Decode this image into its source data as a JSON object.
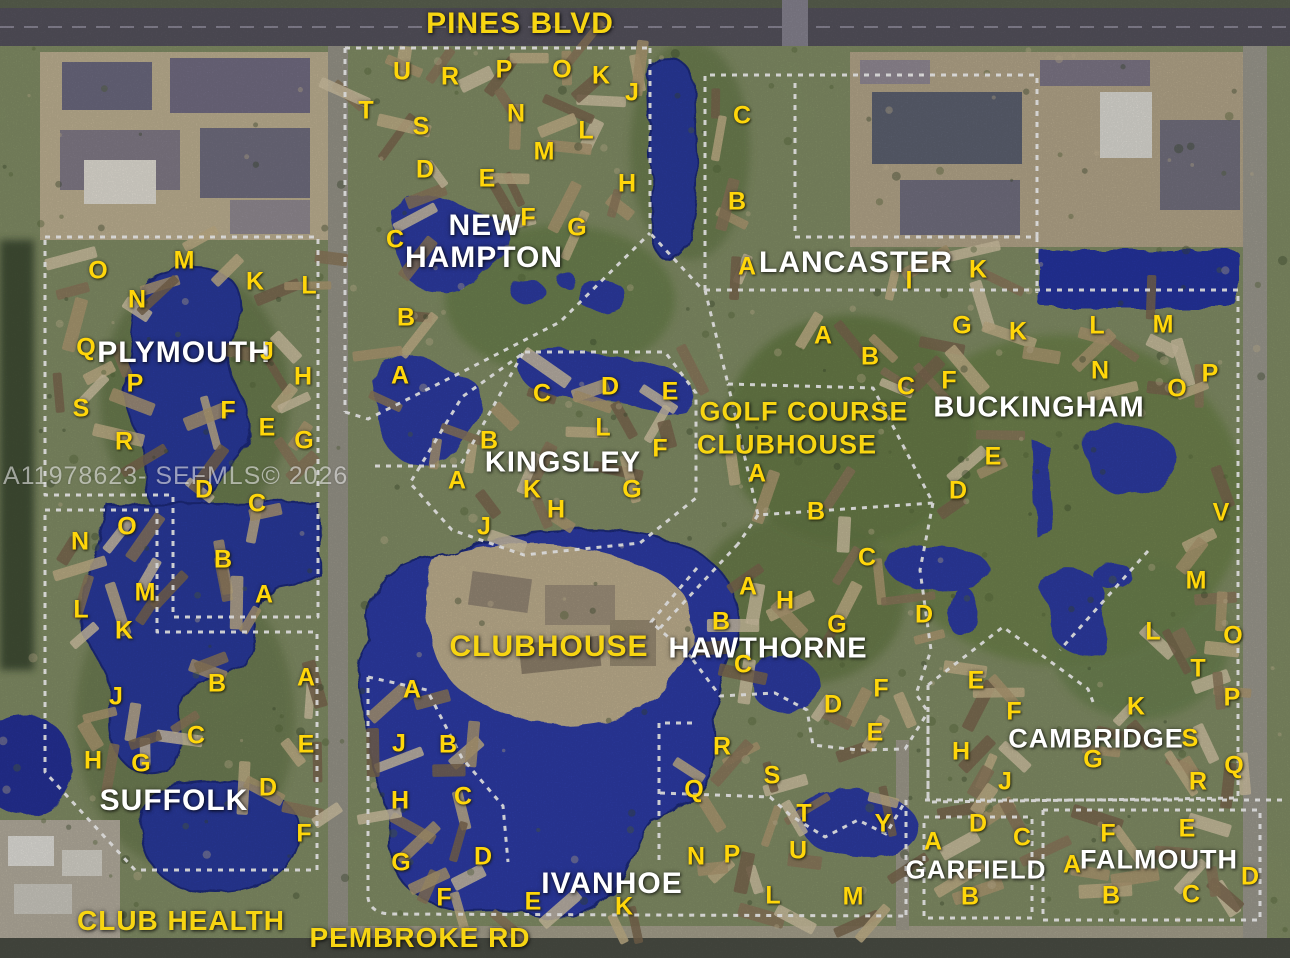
{
  "map": {
    "watermark": "A11978623- SEFMLS© 2026",
    "roads": {
      "labels": [
        {
          "text": "PINES BLVD",
          "x": 520,
          "y": 24,
          "size": 30
        },
        {
          "text": "PEMBROKE RD",
          "x": 420,
          "y": 938,
          "size": 28
        },
        {
          "text": "CLUB HEALTH",
          "x": 181,
          "y": 921,
          "size": 28
        }
      ]
    },
    "facilities": [
      {
        "text": "CLUBHOUSE",
        "x": 549,
        "y": 647,
        "size": 30,
        "color": "yellow"
      },
      {
        "text": "GOLF COURSE",
        "x": 804,
        "y": 412,
        "size": 27,
        "color": "yellow"
      },
      {
        "text": "CLUBHOUSE",
        "x": 787,
        "y": 445,
        "size": 27,
        "color": "yellow"
      }
    ],
    "neighborhoods": [
      {
        "name": "NEW HAMPTON",
        "labels": [
          {
            "text": "NEW",
            "x": 485,
            "y": 226,
            "size": 30
          },
          {
            "text": "HAMPTON",
            "x": 484,
            "y": 258,
            "size": 30
          }
        ],
        "letters": [
          {
            "t": "U",
            "x": 402,
            "y": 72
          },
          {
            "t": "R",
            "x": 450,
            "y": 77
          },
          {
            "t": "P",
            "x": 504,
            "y": 70
          },
          {
            "t": "O",
            "x": 562,
            "y": 70
          },
          {
            "t": "K",
            "x": 601,
            "y": 76
          },
          {
            "t": "J",
            "x": 632,
            "y": 93
          },
          {
            "t": "T",
            "x": 366,
            "y": 111
          },
          {
            "t": "S",
            "x": 421,
            "y": 127
          },
          {
            "t": "N",
            "x": 516,
            "y": 114
          },
          {
            "t": "L",
            "x": 586,
            "y": 131
          },
          {
            "t": "M",
            "x": 544,
            "y": 152
          },
          {
            "t": "D",
            "x": 425,
            "y": 170
          },
          {
            "t": "E",
            "x": 487,
            "y": 179
          },
          {
            "t": "H",
            "x": 627,
            "y": 184
          },
          {
            "t": "F",
            "x": 528,
            "y": 218
          },
          {
            "t": "G",
            "x": 577,
            "y": 228
          },
          {
            "t": "C",
            "x": 395,
            "y": 240
          },
          {
            "t": "B",
            "x": 406,
            "y": 318
          },
          {
            "t": "A",
            "x": 400,
            "y": 376
          }
        ]
      },
      {
        "name": "KINGSLEY",
        "labels": [
          {
            "text": "KINGSLEY",
            "x": 563,
            "y": 463,
            "size": 29
          }
        ],
        "letters": [
          {
            "t": "C",
            "x": 542,
            "y": 394
          },
          {
            "t": "D",
            "x": 610,
            "y": 387
          },
          {
            "t": "E",
            "x": 670,
            "y": 392
          },
          {
            "t": "L",
            "x": 603,
            "y": 428
          },
          {
            "t": "B",
            "x": 489,
            "y": 441
          },
          {
            "t": "F",
            "x": 660,
            "y": 449
          },
          {
            "t": "A",
            "x": 457,
            "y": 481
          },
          {
            "t": "K",
            "x": 532,
            "y": 490
          },
          {
            "t": "G",
            "x": 632,
            "y": 490
          },
          {
            "t": "H",
            "x": 556,
            "y": 510
          },
          {
            "t": "J",
            "x": 484,
            "y": 527
          }
        ]
      },
      {
        "name": "PLYMOUTH",
        "labels": [
          {
            "text": "PLYMOUTH",
            "x": 184,
            "y": 353,
            "size": 30
          }
        ],
        "letters": [
          {
            "t": "M",
            "x": 184,
            "y": 261
          },
          {
            "t": "O",
            "x": 98,
            "y": 271
          },
          {
            "t": "K",
            "x": 255,
            "y": 282
          },
          {
            "t": "L",
            "x": 309,
            "y": 286
          },
          {
            "t": "N",
            "x": 137,
            "y": 300
          },
          {
            "t": "Q",
            "x": 86,
            "y": 348
          },
          {
            "t": "J",
            "x": 267,
            "y": 352
          },
          {
            "t": "H",
            "x": 303,
            "y": 377
          },
          {
            "t": "P",
            "x": 135,
            "y": 384
          },
          {
            "t": "S",
            "x": 81,
            "y": 409
          },
          {
            "t": "F",
            "x": 228,
            "y": 411
          },
          {
            "t": "E",
            "x": 267,
            "y": 428
          },
          {
            "t": "R",
            "x": 124,
            "y": 442
          },
          {
            "t": "G",
            "x": 304,
            "y": 441
          },
          {
            "t": "D",
            "x": 204,
            "y": 490
          },
          {
            "t": "C",
            "x": 257,
            "y": 504
          }
        ]
      },
      {
        "name": "SUFFOLK",
        "labels": [
          {
            "text": "SUFFOLK",
            "x": 174,
            "y": 801,
            "size": 30
          }
        ],
        "letters": [
          {
            "t": "O",
            "x": 127,
            "y": 527
          },
          {
            "t": "N",
            "x": 80,
            "y": 542
          },
          {
            "t": "B",
            "x": 223,
            "y": 560
          },
          {
            "t": "M",
            "x": 145,
            "y": 593
          },
          {
            "t": "A",
            "x": 264,
            "y": 595
          },
          {
            "t": "L",
            "x": 81,
            "y": 610
          },
          {
            "t": "K",
            "x": 124,
            "y": 631
          },
          {
            "t": "B",
            "x": 217,
            "y": 684
          },
          {
            "t": "A",
            "x": 306,
            "y": 678
          },
          {
            "t": "J",
            "x": 116,
            "y": 697
          },
          {
            "t": "C",
            "x": 196,
            "y": 736
          },
          {
            "t": "E",
            "x": 306,
            "y": 745
          },
          {
            "t": "H",
            "x": 93,
            "y": 761
          },
          {
            "t": "G",
            "x": 141,
            "y": 764
          },
          {
            "t": "D",
            "x": 268,
            "y": 788
          },
          {
            "t": "F",
            "x": 304,
            "y": 834
          }
        ]
      },
      {
        "name": "LANCASTER",
        "labels": [
          {
            "text": "LANCASTER",
            "x": 856,
            "y": 263,
            "size": 30
          }
        ],
        "letters": [
          {
            "t": "C",
            "x": 742,
            "y": 116
          },
          {
            "t": "B",
            "x": 737,
            "y": 202
          },
          {
            "t": "A",
            "x": 747,
            "y": 267
          },
          {
            "t": "I",
            "x": 909,
            "y": 281
          },
          {
            "t": "K",
            "x": 978,
            "y": 270
          }
        ]
      },
      {
        "name": "BUCKINGHAM",
        "labels": [
          {
            "text": "BUCKINGHAM",
            "x": 1039,
            "y": 408,
            "size": 29
          }
        ],
        "letters": [
          {
            "t": "A",
            "x": 823,
            "y": 336
          },
          {
            "t": "B",
            "x": 870,
            "y": 357
          },
          {
            "t": "G",
            "x": 962,
            "y": 326
          },
          {
            "t": "K",
            "x": 1018,
            "y": 332
          },
          {
            "t": "C",
            "x": 906,
            "y": 387
          },
          {
            "t": "F",
            "x": 949,
            "y": 381
          },
          {
            "t": "L",
            "x": 1097,
            "y": 326
          },
          {
            "t": "M",
            "x": 1163,
            "y": 325
          },
          {
            "t": "N",
            "x": 1100,
            "y": 371
          },
          {
            "t": "P",
            "x": 1210,
            "y": 374
          },
          {
            "t": "O",
            "x": 1177,
            "y": 389
          },
          {
            "t": "E",
            "x": 993,
            "y": 457
          },
          {
            "t": "D",
            "x": 958,
            "y": 491
          },
          {
            "t": "A",
            "x": 757,
            "y": 474
          },
          {
            "t": "B",
            "x": 816,
            "y": 512
          },
          {
            "t": "V",
            "x": 1221,
            "y": 513
          }
        ]
      },
      {
        "name": "HAWTHORNE",
        "labels": [
          {
            "text": "HAWTHORNE",
            "x": 768,
            "y": 649,
            "size": 29
          }
        ],
        "letters": [
          {
            "t": "C",
            "x": 867,
            "y": 558
          },
          {
            "t": "A",
            "x": 748,
            "y": 587
          },
          {
            "t": "H",
            "x": 785,
            "y": 601
          },
          {
            "t": "B",
            "x": 721,
            "y": 622
          },
          {
            "t": "G",
            "x": 837,
            "y": 625
          },
          {
            "t": "D",
            "x": 924,
            "y": 615
          },
          {
            "t": "C",
            "x": 743,
            "y": 665
          },
          {
            "t": "F",
            "x": 881,
            "y": 689
          },
          {
            "t": "D",
            "x": 833,
            "y": 705
          },
          {
            "t": "E",
            "x": 875,
            "y": 733
          },
          {
            "t": "R",
            "x": 722,
            "y": 747
          },
          {
            "t": "S",
            "x": 772,
            "y": 776
          },
          {
            "t": "Q",
            "x": 694,
            "y": 790
          },
          {
            "t": "T",
            "x": 804,
            "y": 814
          },
          {
            "t": "Y",
            "x": 883,
            "y": 824
          },
          {
            "t": "U",
            "x": 798,
            "y": 851
          },
          {
            "t": "P",
            "x": 732,
            "y": 855
          },
          {
            "t": "N",
            "x": 696,
            "y": 857
          },
          {
            "t": "L",
            "x": 773,
            "y": 896
          },
          {
            "t": "M",
            "x": 853,
            "y": 897
          }
        ]
      },
      {
        "name": "IVANHOE",
        "labels": [
          {
            "text": "IVANHOE",
            "x": 612,
            "y": 884,
            "size": 30
          }
        ],
        "letters": [
          {
            "t": "A",
            "x": 412,
            "y": 690
          },
          {
            "t": "J",
            "x": 399,
            "y": 744
          },
          {
            "t": "B",
            "x": 448,
            "y": 745
          },
          {
            "t": "H",
            "x": 400,
            "y": 801
          },
          {
            "t": "C",
            "x": 463,
            "y": 797
          },
          {
            "t": "G",
            "x": 401,
            "y": 863
          },
          {
            "t": "D",
            "x": 483,
            "y": 857
          },
          {
            "t": "F",
            "x": 444,
            "y": 898
          },
          {
            "t": "E",
            "x": 533,
            "y": 902
          },
          {
            "t": "K",
            "x": 624,
            "y": 907
          }
        ]
      },
      {
        "name": "CAMBRIDGES",
        "labels": [
          {
            "text": "CAMBRIDGE",
            "x": 1096,
            "y": 739,
            "size": 27
          }
        ],
        "letters": [
          {
            "t": "M",
            "x": 1196,
            "y": 581
          },
          {
            "t": "L",
            "x": 1153,
            "y": 632
          },
          {
            "t": "O",
            "x": 1233,
            "y": 636
          },
          {
            "t": "T",
            "x": 1198,
            "y": 669
          },
          {
            "t": "E",
            "x": 976,
            "y": 681
          },
          {
            "t": "P",
            "x": 1232,
            "y": 698
          },
          {
            "t": "K",
            "x": 1136,
            "y": 707
          },
          {
            "t": "F",
            "x": 1014,
            "y": 712
          },
          {
            "t": "S",
            "x": 1190,
            "y": 739
          },
          {
            "t": "H",
            "x": 961,
            "y": 752
          },
          {
            "t": "G",
            "x": 1093,
            "y": 760
          },
          {
            "t": "Q",
            "x": 1234,
            "y": 766
          },
          {
            "t": "R",
            "x": 1198,
            "y": 782
          },
          {
            "t": "J",
            "x": 1005,
            "y": 782
          }
        ]
      },
      {
        "name": "GARFIELD",
        "labels": [
          {
            "text": "GARFIELD",
            "x": 976,
            "y": 870,
            "size": 26
          }
        ],
        "letters": [
          {
            "t": "D",
            "x": 978,
            "y": 824
          },
          {
            "t": "C",
            "x": 1022,
            "y": 838
          },
          {
            "t": "A",
            "x": 933,
            "y": 842
          },
          {
            "t": "B",
            "x": 970,
            "y": 897
          }
        ]
      },
      {
        "name": "FALMOUTH",
        "labels": [
          {
            "text": "FALMOUTH",
            "x": 1159,
            "y": 860,
            "size": 27
          }
        ],
        "letters": [
          {
            "t": "E",
            "x": 1187,
            "y": 829
          },
          {
            "t": "F",
            "x": 1108,
            "y": 834
          },
          {
            "t": "A",
            "x": 1072,
            "y": 865
          },
          {
            "t": "D",
            "x": 1250,
            "y": 877
          },
          {
            "t": "B",
            "x": 1111,
            "y": 896
          },
          {
            "t": "C",
            "x": 1191,
            "y": 895
          }
        ]
      }
    ]
  }
}
